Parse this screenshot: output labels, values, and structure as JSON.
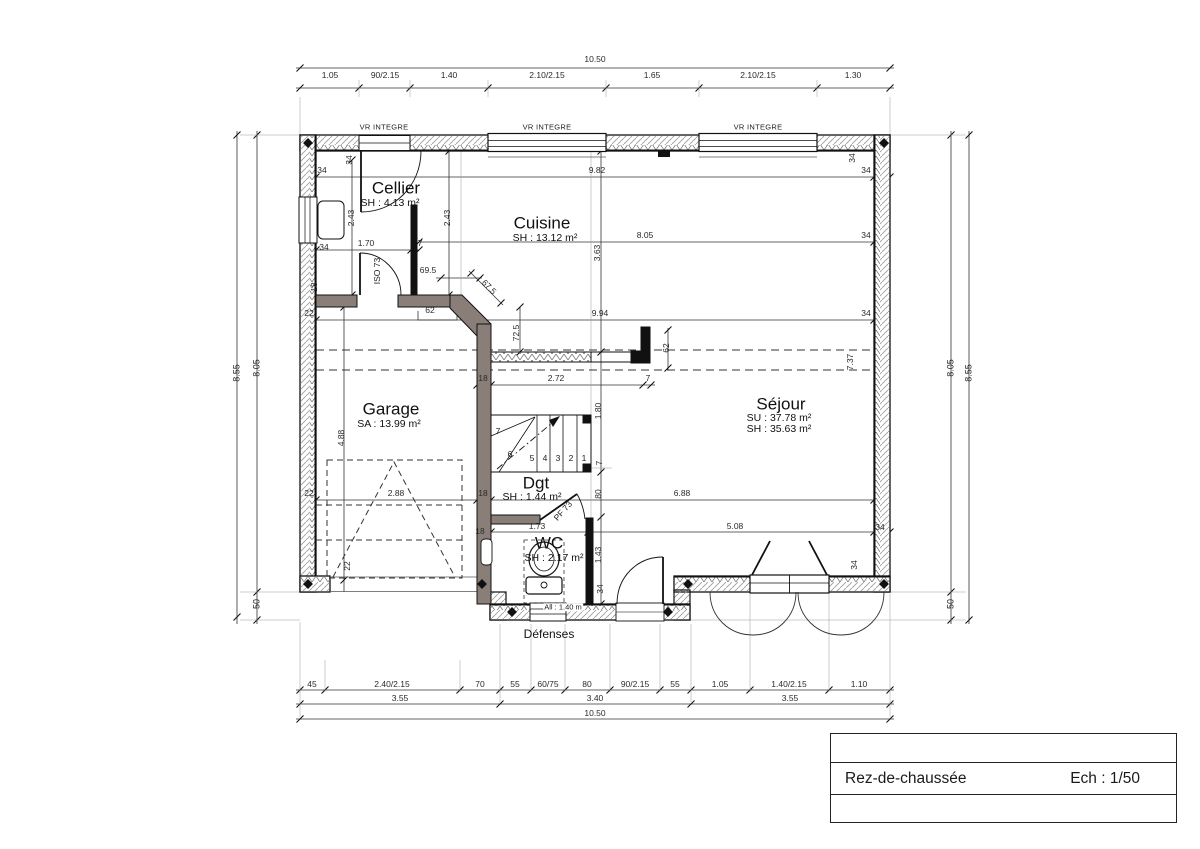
{
  "title_block": {
    "title": "Rez-de-chaussée",
    "scale": "Ech : 1/50"
  },
  "rooms": {
    "cellier": {
      "name": "Cellier",
      "line1": "SH : 4.13 m²"
    },
    "cuisine": {
      "name": "Cuisine",
      "line1": "SH : 13.12 m²"
    },
    "garage": {
      "name": "Garage",
      "line1": "SA : 13.99 m²"
    },
    "sejour": {
      "name": "Séjour",
      "line1": "SU : 37.78 m²",
      "line2": "SH : 35.63 m²"
    },
    "dgt": {
      "name": "Dgt",
      "line1": "SH : 1.44 m²"
    },
    "wc": {
      "name": "WC",
      "line1": "SH : 2.17 m²"
    }
  },
  "labels": {
    "vr": "VR INTEGRE",
    "iso73": "ISO 73",
    "pf73": "PF 73",
    "defenses": "Défenses",
    "allege": "All : 1.40 m"
  },
  "stairs": {
    "steps": [
      "1",
      "2",
      "3",
      "4",
      "5",
      "6",
      "7"
    ]
  },
  "dims": {
    "top_total": "10.50",
    "top_segments": [
      "1.05",
      "90/2.15",
      "1.40",
      "2.10/2.15",
      "1.65",
      "2.10/2.15",
      "1.30"
    ],
    "bottom_row1": [
      "45",
      "2.40/2.15",
      "70",
      "55",
      "60/75",
      "80",
      "90/2.15",
      "55",
      "1.05",
      "1.40/2.15",
      "1.10"
    ],
    "bottom_row2": [
      "3.55",
      "3.40",
      "3.55"
    ],
    "bottom_total": "10.50",
    "left_outer": "8.55",
    "left_inner": "8.05",
    "porch": "50",
    "right_inner": "8.05",
    "right_outer": "8.55",
    "w34": "34",
    "w22": "22",
    "w18": "18",
    "w7": "7",
    "d982": "9.82",
    "d805": "8.05",
    "d994": "9.94",
    "d243": "2.43",
    "d170": "1.70",
    "d695": "69.5",
    "d675": "67.5",
    "d62": "62",
    "d725": "72.5",
    "d363": "3.63",
    "d288": "2.88",
    "d488": "4.88",
    "d272": "2.72",
    "d180": "1.80",
    "d80": "80",
    "d688": "6.88",
    "d173": "1.73",
    "d143": "1.43",
    "d508": "5.08",
    "d737": "7.37"
  }
}
